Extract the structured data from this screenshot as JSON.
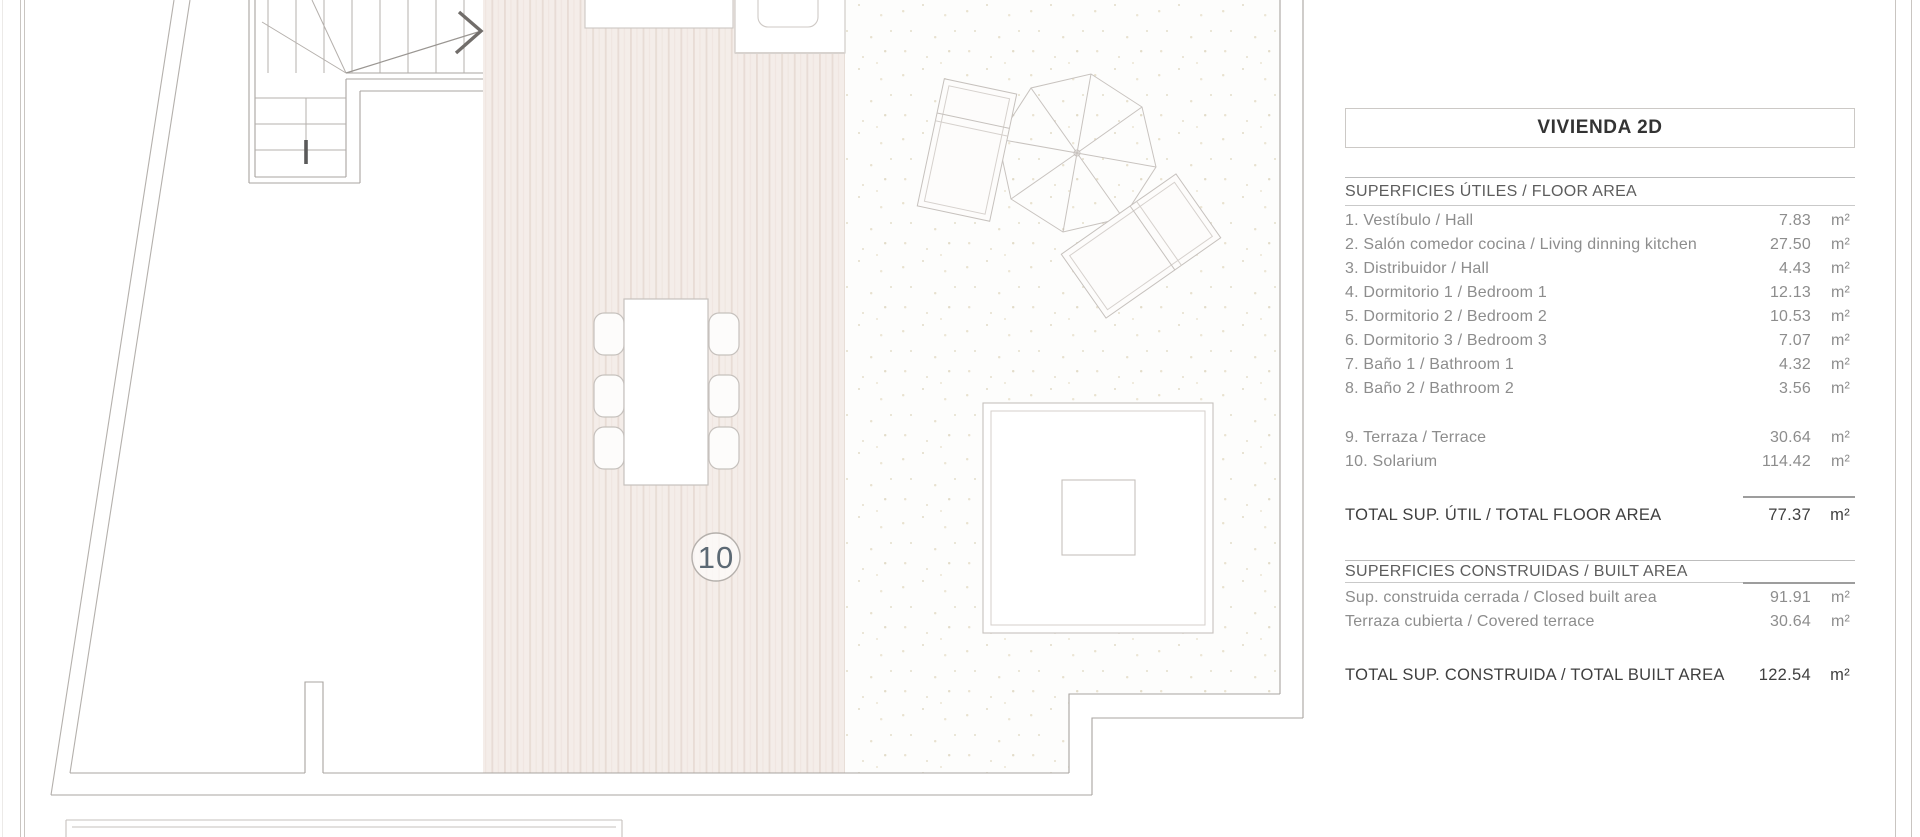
{
  "panel": {
    "title": "VIVIENDA 2D",
    "floor_section_header": "SUPERFICIES ÚTILES / FLOOR AREA",
    "floor_rows": [
      {
        "label": "1. Vestíbulo / Hall",
        "value": "7.83",
        "unit": "m²"
      },
      {
        "label": "2. Salón comedor cocina / Living dinning kitchen",
        "value": "27.50",
        "unit": "m²"
      },
      {
        "label": "3. Distribuidor / Hall",
        "value": "4.43",
        "unit": "m²"
      },
      {
        "label": "4. Dormitorio 1 / Bedroom 1",
        "value": "12.13",
        "unit": "m²"
      },
      {
        "label": "5. Dormitorio 2 / Bedroom 2",
        "value": "10.53",
        "unit": "m²"
      },
      {
        "label": "6. Dormitorio 3 / Bedroom 3",
        "value": "7.07",
        "unit": "m²"
      },
      {
        "label": "7. Baño 1 / Bathroom 1",
        "value": "4.32",
        "unit": "m²"
      },
      {
        "label": "8. Baño 2 / Bathroom 2",
        "value": "3.56",
        "unit": "m²"
      }
    ],
    "outdoor_rows": [
      {
        "label": "9. Terraza / Terrace",
        "value": "30.64",
        "unit": "m²"
      },
      {
        "label": "10. Solarium",
        "value": "114.42",
        "unit": "m²"
      }
    ],
    "floor_total": {
      "label": "TOTAL SUP. ÚTIL / TOTAL FLOOR AREA",
      "value": "77.37",
      "unit": "m²"
    },
    "built_section_header": "SUPERFICIES CONSTRUIDAS / BUILT AREA",
    "built_rows": [
      {
        "label": "Sup. construida cerrada / Closed built area",
        "value": "91.91",
        "unit": "m²"
      },
      {
        "label": "Terraza cubierta / Covered terrace",
        "value": "30.64",
        "unit": "m²"
      }
    ],
    "built_total": {
      "label": "TOTAL SUP. CONSTRUIDA /  TOTAL BUILT AREA",
      "value": "122.54",
      "unit": "m²"
    }
  },
  "plan": {
    "solarium_label": "10"
  },
  "colors": {
    "plan_line": "#c6c1bd",
    "wall_line": "#a8a4a0",
    "deck_fill": "#f4ede9",
    "deck_stripe": "#e8dcd5",
    "stipple_dot": "#e6dfcc",
    "solarium_label_text": "#5c6974",
    "row_text": "#8d8d8d",
    "total_text": "#3f3f3f"
  }
}
